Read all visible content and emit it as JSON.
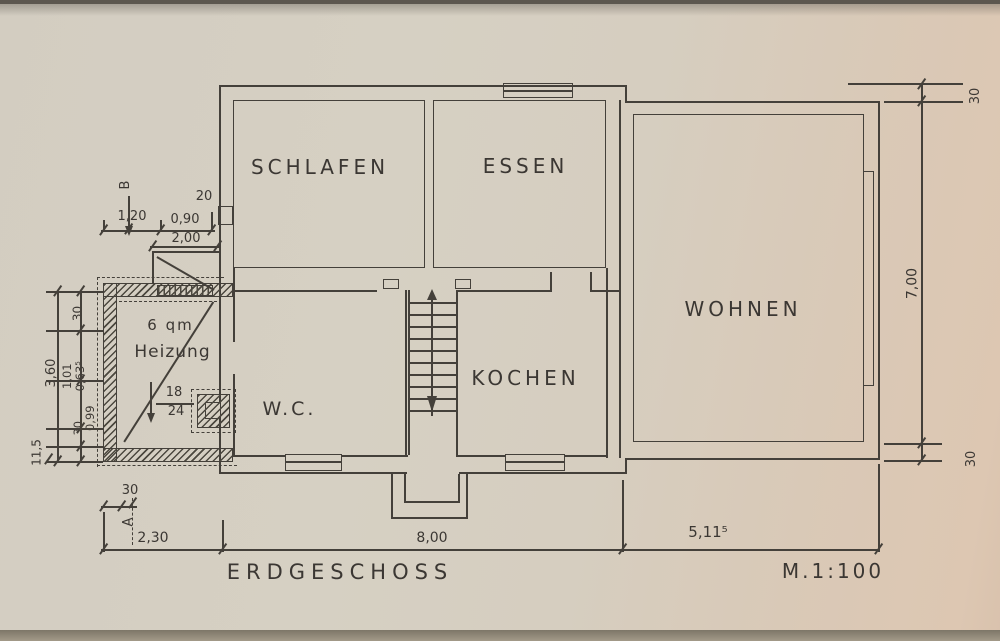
{
  "drawing": {
    "title": "ERDGESCHOSS",
    "scale": "M.1:100",
    "rooms": {
      "schlafen": "SCHLAFEN",
      "essen": "ESSEN",
      "wohnen": "WOHNEN",
      "kochen": "KOCHEN",
      "wc": "W.C.",
      "heizung_area": "6 qm",
      "heizung": "Heizung",
      "flue_num": "18",
      "flue_den": "24"
    },
    "sections": {
      "a": "A",
      "b": "B"
    },
    "dims": {
      "t20": "20",
      "t120": "1,20",
      "t090": "0,90",
      "t200": "2,00",
      "l30a": "30",
      "l360": "3,60",
      "l101": "1,01",
      "l0635": "0,63⁵",
      "l099": "0,99",
      "l30b": "30",
      "l115": "11,5",
      "bl30": "30",
      "b230": "2,30",
      "b800": "8,00",
      "b5115": "5,11⁵",
      "r30a": "30",
      "r700": "7,00",
      "r30b": "30"
    }
  }
}
